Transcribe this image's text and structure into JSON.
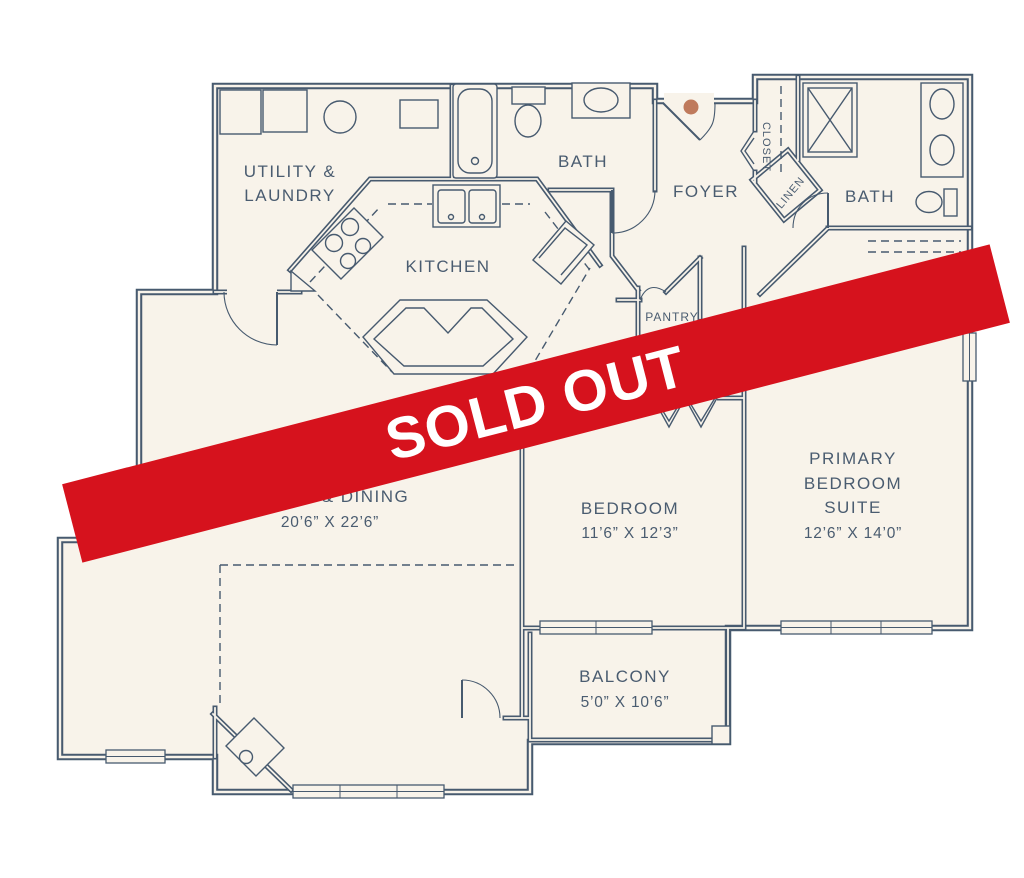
{
  "palette": {
    "background": "#ffffff",
    "floor": "#f8f3ea",
    "wall": "#475a6f",
    "label": "#4a5c70",
    "banner_red": "#d6121d",
    "banner_text": "#ffffff",
    "entry_dot": "#bf7a5c"
  },
  "banner": {
    "label": "SOLD OUT"
  },
  "plan": {
    "rooms": {
      "utility_laundry": {
        "line1": "UTILITY &",
        "line2": "LAUNDRY"
      },
      "bath_1": {
        "label": "BATH"
      },
      "foyer": {
        "label": "FOYER"
      },
      "closet": {
        "label": "CLOSET"
      },
      "linen": {
        "label": "LINEN"
      },
      "bath_2": {
        "label": "BATH"
      },
      "kitchen": {
        "label": "KITCHEN"
      },
      "pantry": {
        "label": "PANTRY"
      },
      "living_dining": {
        "label": "LIVING & DINING",
        "dimensions": "20’6” X 22’6”"
      },
      "bedroom": {
        "label": "BEDROOM",
        "dimensions": "11’6” X 12’3”"
      },
      "primary_bedroom": {
        "line1": "PRIMARY",
        "line2": "BEDROOM",
        "line3": "SUITE",
        "dimensions": "12’6” X 14’0”"
      },
      "balcony": {
        "label": "BALCONY",
        "dimensions": "5’0” X 10’6”"
      }
    }
  }
}
